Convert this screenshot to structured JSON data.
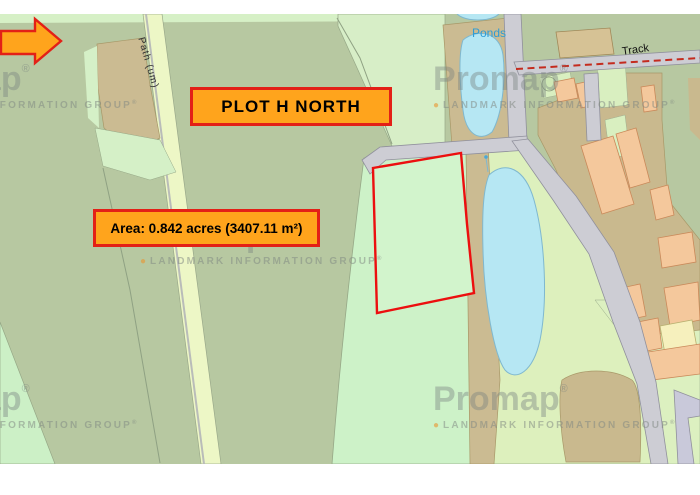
{
  "map": {
    "plot_label": "PLOT H NORTH",
    "area_label": "Area: 0.842 acres (3407.11 m²)",
    "labels": {
      "ponds": "Ponds",
      "track": "Track",
      "path": "Path (um)"
    },
    "watermark": {
      "brand": "Promap",
      "registered": "®",
      "dot": "●",
      "tagline": "LANDMARK INFORMATION GROUP"
    },
    "colors": {
      "field_sage": "#b7c8a1",
      "field_mint": "#cdf2c8",
      "field_light": "#ddf0bd",
      "path_pale": "#edf7c6",
      "tan": "#cbbb92",
      "building_orange": "#f4c89c",
      "building_yellow": "#f6f0bd",
      "road_gray": "#cdcdd4",
      "pond_blue": "#b6e7f3",
      "plot_outline_red": "#ec0f0f",
      "annotation_orange": "#ffa41c",
      "annotation_border_red": "#e32017",
      "track_dash_red": "#c42b1e",
      "ponds_text_blue": "#2e9cd6"
    }
  }
}
